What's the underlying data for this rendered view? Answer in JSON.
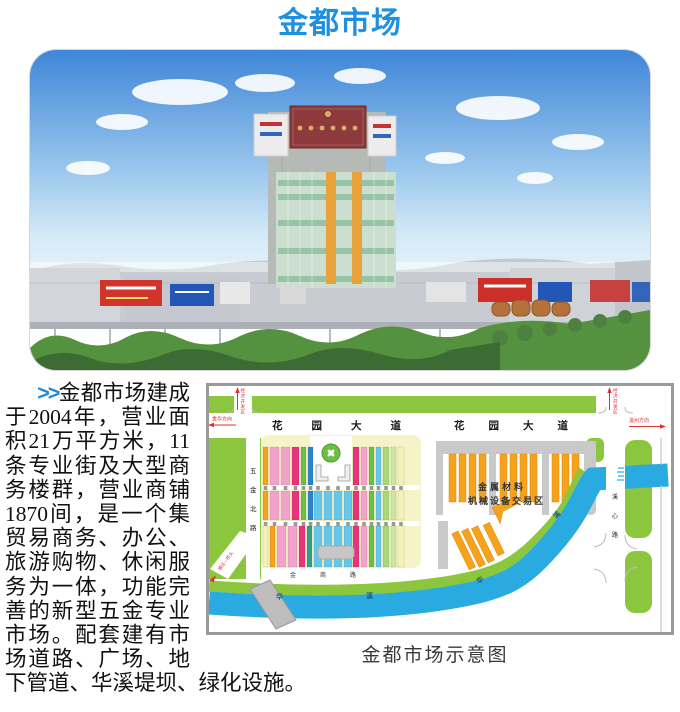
{
  "title": "金都市场",
  "intro": {
    "marker": ">>",
    "body": "金都市场建成于2004年，营业面积21万平方米，11条专业街及大型商务楼群，营业商铺1870间，是一个集贸易商务、办公、旅游购物、休闲服务为一体，功能完善的新型五金专业市场。配套建有市场道路、广场、地下管道、华溪堤坝、绿化设施。"
  },
  "map": {
    "caption": "金都市场示意图",
    "roads": {
      "garden_avenue_west": "花园大道",
      "garden_avenue_east": "花园大道",
      "wujin_north_road": "五金北路",
      "xixin_road": "溪心路",
      "jinshang_road": "金商路"
    },
    "directions": {
      "jinhua": "金华方向",
      "wenzhou": "温州方向",
      "econ_zone_west": "经济开发区",
      "econ_zone_east": "经济开发区",
      "bridge_road": "通往—桥头"
    },
    "zones": {
      "metal_line1": "金属材料",
      "metal_line2": "机械设备交易区"
    },
    "river": {
      "chars": [
        "华",
        "溪",
        "华",
        "溪"
      ]
    },
    "colors": {
      "green": "#8CC63F",
      "river_blue": "#29ABE2",
      "cream": "#F6F3C8",
      "orange": "#F6A21C",
      "gray_block": "#C9C9C9",
      "red_label": "#E03131",
      "title_blue": "#1E8FE1"
    },
    "bars": {
      "rows": [
        {
          "y": 64,
          "h": 38,
          "items": [
            [
              57,
              5,
              "#F6A21C"
            ],
            [
              64,
              9,
              "#F2A3CC"
            ],
            [
              75,
              9,
              "#F2A3CC"
            ],
            [
              86,
              7,
              "#E8337F"
            ],
            [
              95,
              5,
              "#6DBE45"
            ],
            [
              102,
              5,
              "#2B83C9"
            ],
            [
              147,
              6,
              "#E8337F"
            ],
            [
              155,
              6,
              "#F2A3CC"
            ],
            [
              163,
              5,
              "#6DBE45"
            ],
            [
              170,
              5,
              "#66C7EC"
            ],
            [
              177,
              6,
              "#A9D879"
            ],
            [
              185,
              5,
              "#CDE6A0"
            ],
            [
              192,
              6,
              "#F5F2B8"
            ]
          ]
        },
        {
          "y": 108,
          "h": 29,
          "items": [
            [
              57,
              5,
              "#F6A21C"
            ],
            [
              64,
              9,
              "#F2A3CC"
            ],
            [
              75,
              9,
              "#F2A3CC"
            ],
            [
              86,
              7,
              "#E8337F"
            ],
            [
              95,
              5,
              "#6DBE45"
            ],
            [
              102,
              5,
              "#2B83C9"
            ],
            [
              108,
              8,
              "#66C7EC"
            ],
            [
              118,
              8,
              "#66C7EC"
            ],
            [
              128,
              8,
              "#66C7EC"
            ],
            [
              138,
              8,
              "#66C7EC"
            ],
            [
              147,
              6,
              "#E8337F"
            ],
            [
              155,
              6,
              "#F2A3CC"
            ],
            [
              163,
              5,
              "#6DBE45"
            ],
            [
              170,
              5,
              "#66C7EC"
            ],
            [
              177,
              6,
              "#A9D879"
            ],
            [
              185,
              5,
              "#CDE6A0"
            ],
            [
              192,
              6,
              "#F5F2B8"
            ]
          ]
        },
        {
          "y": 143,
          "h": 41,
          "items": [
            [
              57,
              5,
              "#F5F2B8"
            ],
            [
              64,
              5,
              "#F6A21C"
            ],
            [
              71,
              9,
              "#F2A3CC"
            ],
            [
              82,
              9,
              "#F2A3CC"
            ],
            [
              93,
              6,
              "#E8337F"
            ],
            [
              101,
              5,
              "#2E9E8F"
            ],
            [
              108,
              8,
              "#66C7EC"
            ],
            [
              118,
              8,
              "#66C7EC"
            ],
            [
              128,
              8,
              "#66C7EC"
            ],
            [
              138,
              8,
              "#66C7EC"
            ],
            [
              147,
              6,
              "#E8337F"
            ],
            [
              155,
              6,
              "#F2A3CC"
            ],
            [
              163,
              5,
              "#6DBE45"
            ],
            [
              170,
              5,
              "#66C7EC"
            ],
            [
              177,
              6,
              "#A9D879"
            ],
            [
              185,
              5,
              "#CDE6A0"
            ],
            [
              192,
              6,
              "#F5F2B8"
            ]
          ]
        }
      ],
      "separator_y": [
        103,
        139
      ],
      "separator_color": "#999999"
    }
  }
}
